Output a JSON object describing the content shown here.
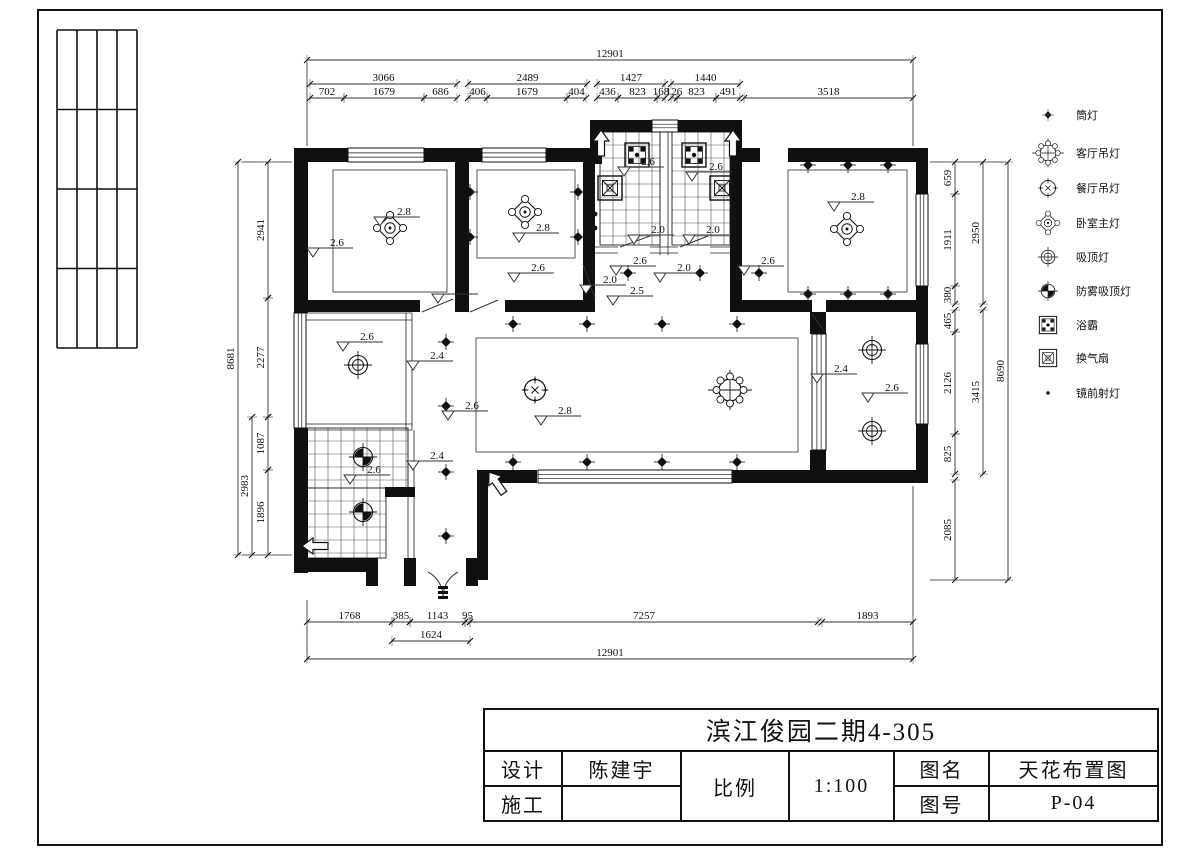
{
  "colors": {
    "ink": "#111111",
    "dim_line": "#333333",
    "thin": "#222222",
    "grid": "#555555"
  },
  "titleblock": {
    "project": "滨江俊园二期4-305",
    "design_label": "设计",
    "designer": "陈建宇",
    "construct_label": "施工",
    "constructor": "",
    "scale_label": "比例",
    "scale_value": "1:100",
    "name_label": "图名",
    "name_value": "天花布置图",
    "no_label": "图号",
    "no_value": "P-04"
  },
  "legend": {
    "items": [
      {
        "symbol": "downlight",
        "label": "筒灯",
        "y": 115
      },
      {
        "symbol": "living_chandelier",
        "label": "客厅吊灯",
        "y": 153
      },
      {
        "symbol": "dining_chandelier",
        "label": "餐厅吊灯",
        "y": 188
      },
      {
        "symbol": "bedroom_main",
        "label": "卧室主灯",
        "y": 223
      },
      {
        "symbol": "ceiling_lamp",
        "label": "吸顶灯",
        "y": 257
      },
      {
        "symbol": "fog_ceiling_lamp",
        "label": "防雾吸顶灯",
        "y": 291
      },
      {
        "symbol": "bath_heater",
        "label": "浴霸",
        "y": 325
      },
      {
        "symbol": "exhaust_fan",
        "label": "换气扇",
        "y": 358
      },
      {
        "symbol": "mirror_spotlight",
        "label": "镜前射灯",
        "y": 393
      }
    ]
  },
  "frame": {
    "border": [
      38,
      10,
      1124,
      835
    ],
    "fold_grid": {
      "x": 57,
      "y": 30,
      "w": 80,
      "h": 318,
      "cols": 4,
      "rows": 4
    }
  },
  "plan": {
    "walls": [
      [
        294,
        148,
        14,
        165
      ],
      [
        294,
        148,
        54,
        14
      ],
      [
        424,
        148,
        58,
        14
      ],
      [
        546,
        148,
        46,
        14
      ],
      [
        590,
        120,
        62,
        12
      ],
      [
        678,
        120,
        64,
        12
      ],
      [
        590,
        120,
        12,
        44
      ],
      [
        730,
        120,
        12,
        44
      ],
      [
        742,
        148,
        18,
        14
      ],
      [
        788,
        148,
        140,
        14
      ],
      [
        916,
        162,
        12,
        32
      ],
      [
        916,
        286,
        12,
        58
      ],
      [
        916,
        424,
        12,
        59
      ],
      [
        455,
        162,
        14,
        150
      ],
      [
        583,
        162,
        12,
        150
      ],
      [
        730,
        162,
        12,
        150
      ],
      [
        294,
        300,
        50,
        12
      ],
      [
        344,
        300,
        76,
        12
      ],
      [
        455,
        300,
        14,
        12
      ],
      [
        505,
        300,
        80,
        12
      ],
      [
        730,
        300,
        82,
        12
      ],
      [
        826,
        300,
        102,
        12
      ],
      [
        810,
        312,
        16,
        22
      ],
      [
        810,
        450,
        16,
        25
      ],
      [
        732,
        470,
        196,
        13
      ],
      [
        477,
        470,
        60,
        13
      ],
      [
        477,
        470,
        11,
        110
      ],
      [
        294,
        428,
        14,
        145
      ],
      [
        294,
        558,
        72,
        14
      ],
      [
        366,
        558,
        12,
        28
      ],
      [
        404,
        558,
        12,
        28
      ],
      [
        466,
        558,
        12,
        28
      ],
      [
        385,
        487,
        30,
        10
      ]
    ],
    "windows": [
      {
        "x": 348,
        "y": 148,
        "w": 76,
        "h": 14,
        "o": "h"
      },
      {
        "x": 482,
        "y": 148,
        "w": 64,
        "h": 14,
        "o": "h"
      },
      {
        "x": 652,
        "y": 120,
        "w": 26,
        "h": 12,
        "o": "h"
      },
      {
        "x": 916,
        "y": 194,
        "w": 12,
        "h": 92,
        "o": "v"
      },
      {
        "x": 916,
        "y": 344,
        "w": 12,
        "h": 80,
        "o": "v"
      },
      {
        "x": 294,
        "y": 313,
        "w": 12,
        "h": 115,
        "o": "v"
      },
      {
        "x": 538,
        "y": 470,
        "w": 194,
        "h": 13,
        "o": "h"
      },
      {
        "x": 812,
        "y": 334,
        "w": 14,
        "h": 116,
        "o": "v"
      }
    ],
    "grids": [
      {
        "x": 600,
        "y": 132,
        "w": 60,
        "h": 113,
        "c": 13
      },
      {
        "x": 672,
        "y": 132,
        "w": 58,
        "h": 113,
        "c": 13
      },
      {
        "x": 302,
        "y": 428,
        "w": 106,
        "h": 60,
        "c": 13
      },
      {
        "x": 302,
        "y": 488,
        "w": 84,
        "h": 70,
        "c": 13
      }
    ],
    "inner_rects": [
      [
        333,
        170,
        114,
        122
      ],
      [
        477,
        170,
        98,
        88
      ],
      [
        788,
        170,
        119,
        122
      ],
      [
        476,
        338,
        322,
        114
      ]
    ],
    "thin_lines": [
      [
        294,
        313,
        412,
        313
      ],
      [
        294,
        320,
        412,
        320
      ],
      [
        406,
        313,
        406,
        430
      ],
      [
        412,
        313,
        412,
        430
      ],
      [
        294,
        424,
        412,
        424
      ],
      [
        294,
        430,
        412,
        430
      ],
      [
        408,
        430,
        408,
        558
      ],
      [
        414,
        430,
        414,
        558
      ],
      [
        660,
        120,
        660,
        255
      ],
      [
        668,
        120,
        668,
        255
      ],
      [
        595,
        247,
        618,
        247
      ],
      [
        650,
        247,
        678,
        247
      ],
      [
        710,
        247,
        730,
        247
      ],
      [
        595,
        253,
        618,
        253
      ],
      [
        650,
        253,
        678,
        253
      ],
      [
        710,
        253,
        730,
        253
      ],
      [
        307,
        62,
        307,
        146
      ],
      [
        913,
        62,
        913,
        146
      ],
      [
        307,
        600,
        307,
        658
      ],
      [
        913,
        486,
        913,
        658
      ],
      [
        242,
        162,
        292,
        162
      ],
      [
        242,
        555,
        292,
        555
      ],
      [
        930,
        162,
        1006,
        162
      ],
      [
        930,
        580,
        1006,
        580
      ]
    ],
    "doors": [
      "M422,312 L453,299",
      "M470,312 L498,300",
      "M583,264 L595,298",
      "M812,314 L825,332",
      "M620,247 L650,236",
      "M680,247 L708,236",
      "M428,572 A28,28 0 0 1 443,598",
      "M458,572 A28,28 0 0 0 443,598"
    ],
    "hatches": [
      [
        438,
        586,
        10,
        3
      ],
      [
        438,
        591,
        10,
        3
      ],
      [
        438,
        596,
        10,
        3
      ]
    ],
    "arrows": [
      {
        "x": 601,
        "y": 130,
        "r": 0
      },
      {
        "x": 733,
        "y": 130,
        "r": 0
      },
      {
        "x": 489,
        "y": 472,
        "r": -35
      },
      {
        "x": 302,
        "y": 546,
        "r": -90
      }
    ],
    "symbols": [
      {
        "t": "bedroom_main",
        "x": 390,
        "y": 228
      },
      {
        "t": "bedroom_main",
        "x": 525,
        "y": 212
      },
      {
        "t": "bedroom_main",
        "x": 847,
        "y": 229
      },
      {
        "t": "living_chandelier",
        "x": 730,
        "y": 390
      },
      {
        "t": "dining_chandelier",
        "x": 535,
        "y": 390
      },
      {
        "t": "ceiling_lamp",
        "x": 358,
        "y": 365
      },
      {
        "t": "ceiling_lamp",
        "x": 872,
        "y": 350
      },
      {
        "t": "ceiling_lamp",
        "x": 872,
        "y": 431
      },
      {
        "t": "fog_ceiling_lamp",
        "x": 363,
        "y": 457
      },
      {
        "t": "fog_ceiling_lamp",
        "x": 363,
        "y": 512
      },
      {
        "t": "bath_heater",
        "x": 637,
        "y": 155
      },
      {
        "t": "bath_heater",
        "x": 694,
        "y": 155
      },
      {
        "t": "exhaust_fan",
        "x": 610,
        "y": 188
      },
      {
        "t": "exhaust_fan",
        "x": 722,
        "y": 188
      },
      {
        "t": "downlight",
        "x": 470,
        "y": 192
      },
      {
        "t": "downlight",
        "x": 578,
        "y": 192
      },
      {
        "t": "downlight",
        "x": 470,
        "y": 237
      },
      {
        "t": "downlight",
        "x": 578,
        "y": 237
      },
      {
        "t": "downlight",
        "x": 808,
        "y": 165
      },
      {
        "t": "downlight",
        "x": 848,
        "y": 165
      },
      {
        "t": "downlight",
        "x": 888,
        "y": 165
      },
      {
        "t": "downlight",
        "x": 808,
        "y": 294
      },
      {
        "t": "downlight",
        "x": 848,
        "y": 294
      },
      {
        "t": "downlight",
        "x": 888,
        "y": 294
      },
      {
        "t": "downlight",
        "x": 513,
        "y": 324
      },
      {
        "t": "downlight",
        "x": 587,
        "y": 324
      },
      {
        "t": "downlight",
        "x": 662,
        "y": 324
      },
      {
        "t": "downlight",
        "x": 737,
        "y": 324
      },
      {
        "t": "downlight",
        "x": 513,
        "y": 462
      },
      {
        "t": "downlight",
        "x": 587,
        "y": 462
      },
      {
        "t": "downlight",
        "x": 662,
        "y": 462
      },
      {
        "t": "downlight",
        "x": 737,
        "y": 462
      },
      {
        "t": "downlight",
        "x": 446,
        "y": 342
      },
      {
        "t": "downlight",
        "x": 446,
        "y": 406
      },
      {
        "t": "downlight",
        "x": 446,
        "y": 472
      },
      {
        "t": "downlight",
        "x": 446,
        "y": 536
      },
      {
        "t": "downlight",
        "x": 628,
        "y": 273
      },
      {
        "t": "downlight",
        "x": 700,
        "y": 273
      },
      {
        "t": "downlight",
        "x": 759,
        "y": 273
      },
      {
        "t": "mirror_spotlight",
        "x": 595,
        "y": 214
      },
      {
        "t": "mirror_spotlight",
        "x": 595,
        "y": 228
      },
      {
        "t": "mirror_spotlight",
        "x": 738,
        "y": 214
      },
      {
        "t": "mirror_spotlight",
        "x": 738,
        "y": 228
      }
    ],
    "elevations": [
      {
        "v": "2.8",
        "x": 374,
        "y": 217
      },
      {
        "v": "2.6",
        "x": 307,
        "y": 248
      },
      {
        "v": "2.8",
        "x": 513,
        "y": 233
      },
      {
        "v": "2.6",
        "x": 508,
        "y": 273
      },
      {
        "v": "2.0",
        "x": 432,
        "y": 294
      },
      {
        "v": "2.6",
        "x": 618,
        "y": 167
      },
      {
        "v": "2.6",
        "x": 686,
        "y": 172
      },
      {
        "v": "2.0",
        "x": 628,
        "y": 235
      },
      {
        "v": "2.0",
        "x": 683,
        "y": 235
      },
      {
        "v": "2.6",
        "x": 610,
        "y": 266
      },
      {
        "v": "2.0",
        "x": 580,
        "y": 285
      },
      {
        "v": "2.5",
        "x": 607,
        "y": 296
      },
      {
        "v": "2.0",
        "x": 654,
        "y": 273
      },
      {
        "v": "2.6",
        "x": 738,
        "y": 266
      },
      {
        "v": "2.8",
        "x": 828,
        "y": 202
      },
      {
        "v": "2.8",
        "x": 535,
        "y": 416
      },
      {
        "v": "2.6",
        "x": 442,
        "y": 411
      },
      {
        "v": "2.6",
        "x": 337,
        "y": 342
      },
      {
        "v": "2.4",
        "x": 407,
        "y": 361
      },
      {
        "v": "2.6",
        "x": 344,
        "y": 475
      },
      {
        "v": "2.4",
        "x": 407,
        "y": 461
      },
      {
        "v": "2.4",
        "x": 811,
        "y": 374
      },
      {
        "v": "2.6",
        "x": 862,
        "y": 393
      }
    ]
  },
  "dims": {
    "top": [
      {
        "y": 60,
        "segs": [
          [
            "12901",
            307,
            913
          ]
        ]
      },
      {
        "y": 84,
        "segs": [
          [
            "3066",
            310,
            457
          ],
          [
            "2489",
            468,
            587
          ],
          [
            "1427",
            597,
            665
          ],
          [
            "1440",
            671,
            740
          ]
        ]
      },
      {
        "y": 98,
        "segs": [
          [
            "702",
            310,
            344
          ],
          [
            "1679",
            344,
            424
          ],
          [
            "686",
            424,
            457
          ],
          [
            "406",
            468,
            487
          ],
          [
            "1679",
            487,
            567
          ],
          [
            "404",
            567,
            586
          ],
          [
            "436",
            597,
            618
          ],
          [
            "823",
            618,
            657
          ],
          [
            "168",
            657,
            665
          ],
          [
            "126",
            671,
            677
          ],
          [
            "823",
            677,
            716
          ],
          [
            "491",
            716,
            740
          ],
          [
            "3518",
            744,
            913
          ]
        ]
      }
    ],
    "bottom": [
      {
        "y": 622,
        "segs": [
          [
            "1768",
            307,
            392
          ],
          [
            "385",
            392,
            410
          ],
          [
            "1143",
            410,
            465
          ],
          [
            "95",
            465,
            470
          ],
          [
            "7257",
            470,
            818
          ],
          [
            "1893",
            822,
            913
          ]
        ]
      },
      {
        "y": 641,
        "segs": [
          [
            "1624",
            392,
            470
          ]
        ]
      },
      {
        "y": 659,
        "segs": [
          [
            "12901",
            307,
            913
          ]
        ]
      }
    ],
    "left": [
      {
        "x": 268,
        "segs": [
          [
            "2941",
            162,
            298
          ],
          [
            "2277",
            298,
            417
          ],
          [
            "1087",
            417,
            470
          ],
          [
            "1896",
            470,
            555
          ]
        ]
      },
      {
        "x": 252,
        "segs": [
          [
            "2983",
            417,
            555
          ]
        ]
      },
      {
        "x": 238,
        "segs": [
          [
            "8681",
            162,
            555
          ]
        ]
      }
    ],
    "right": [
      {
        "x": 955,
        "segs": [
          [
            "659",
            162,
            194
          ],
          [
            "1911",
            194,
            286
          ],
          [
            "380",
            286,
            304
          ],
          [
            "465",
            310,
            332
          ],
          [
            "2126",
            332,
            434
          ],
          [
            "825",
            434,
            474
          ],
          [
            "2085",
            480,
            580
          ]
        ]
      },
      {
        "x": 983,
        "segs": [
          [
            "2950",
            162,
            304
          ],
          [
            "3415",
            310,
            474
          ]
        ]
      },
      {
        "x": 1008,
        "segs": [
          [
            "8690",
            162,
            580
          ]
        ]
      }
    ]
  }
}
